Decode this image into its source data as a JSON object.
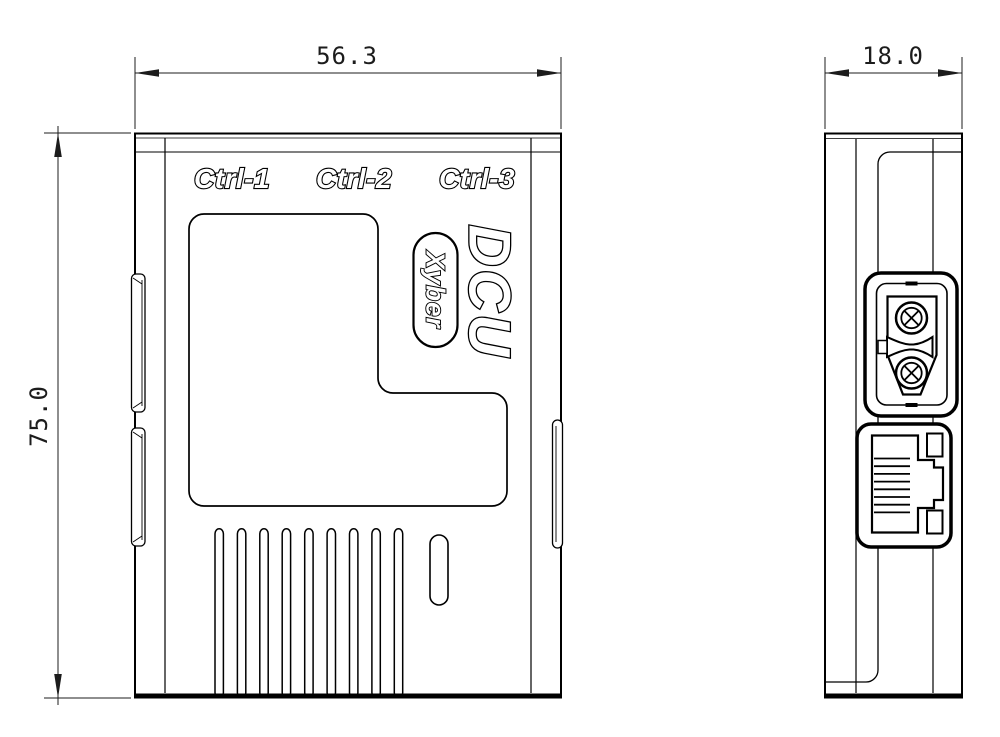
{
  "dimensions": {
    "front_width": "56.3",
    "front_height": "75.0",
    "side_depth": "18.0"
  },
  "front_view": {
    "port_labels": [
      "Ctrl-1",
      "Ctrl-2",
      "Ctrl-3"
    ],
    "product_name": "DCU",
    "brand_name": "Xyber",
    "vent_slot_count": 9
  },
  "side_view": {
    "connectors": [
      "xt30-power-connector",
      "rj45-ethernet-port"
    ]
  },
  "colors": {
    "line": "#000000",
    "background": "#ffffff",
    "dimension_text": "#1c1c1c"
  }
}
